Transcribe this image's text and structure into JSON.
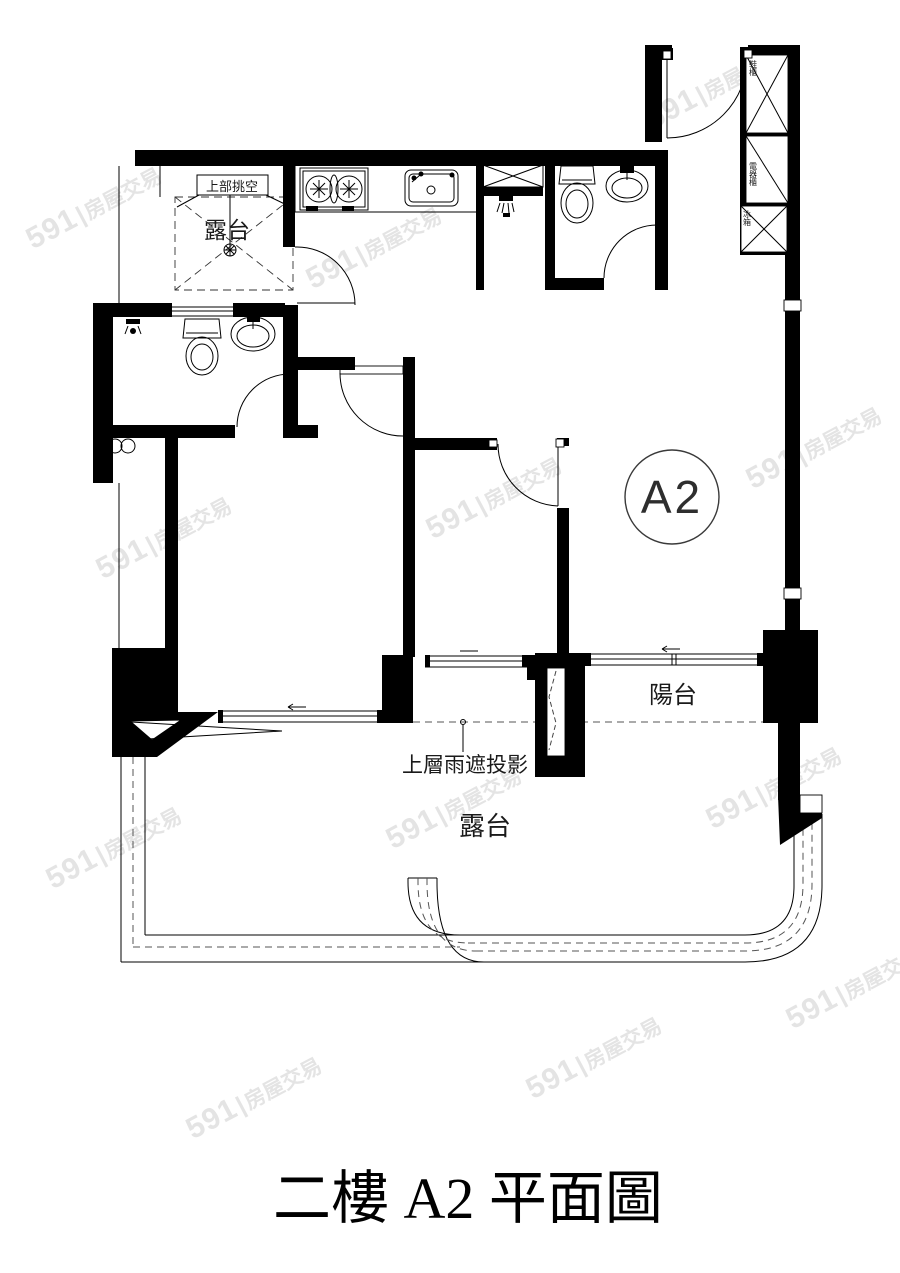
{
  "title": "二樓 A2 平面圖",
  "watermark": {
    "brand": "591",
    "divider": "|",
    "suffix": "房屋交易"
  },
  "plan": {
    "unit_label": "A2",
    "labels": {
      "void_above": "上部挑空",
      "terrace_top": "露台",
      "balcony": "陽台",
      "rain_cover_projection": "上層雨遮投影",
      "terrace_bottom": "露台",
      "cabinet_top": "鞋櫃",
      "cabinet_middle": "電器櫃",
      "cabinet_bottom": "冰箱"
    }
  },
  "colors": {
    "wall": "#000000",
    "watermark": "#e4e4e4",
    "background": "#ffffff"
  }
}
